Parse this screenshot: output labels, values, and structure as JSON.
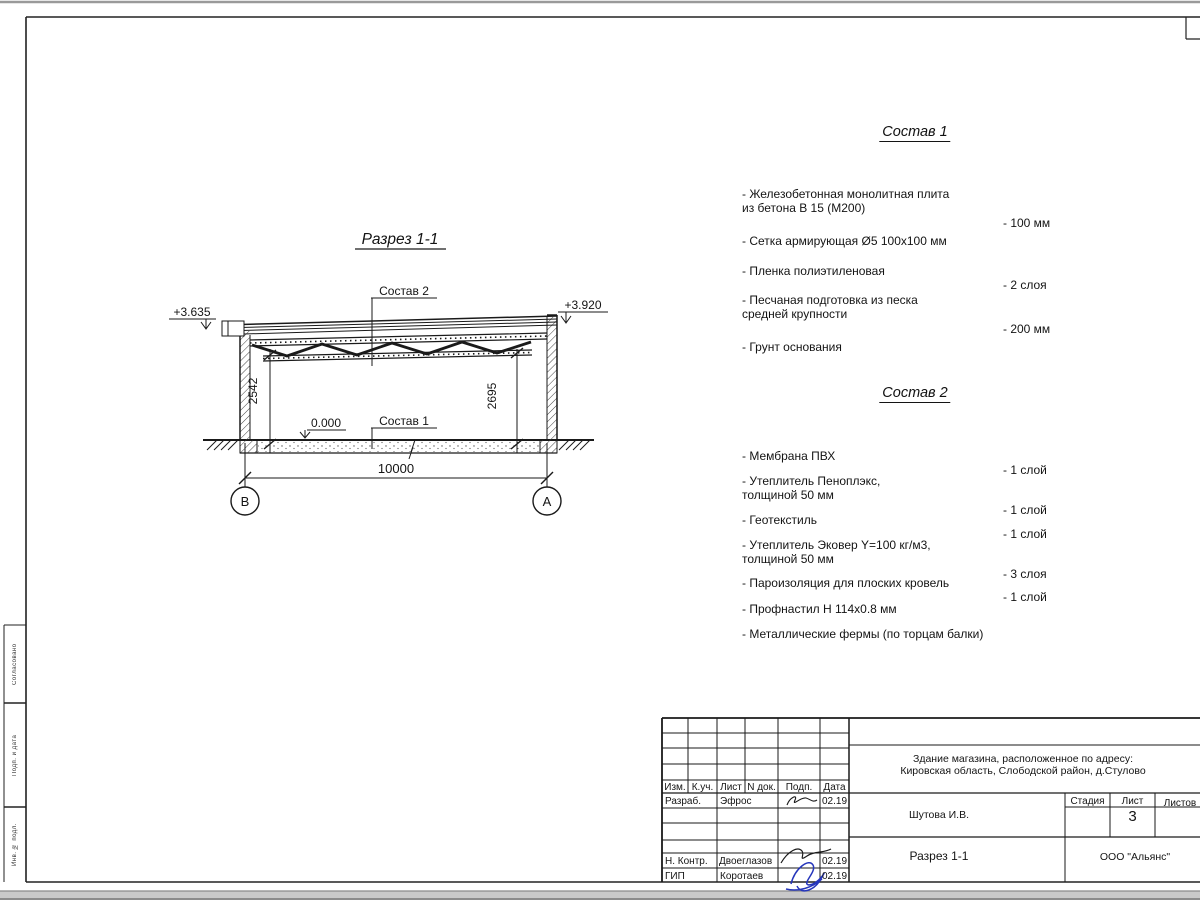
{
  "drawing": {
    "title": "Разрез 1-1",
    "elev_left": "+3.635",
    "elev_right": "+3.920",
    "label_sostav2": "Состав 2",
    "label_sostav1": "Состав 1",
    "level_zero": "0.000",
    "dim_left": "2542",
    "dim_right": "2695",
    "dim_span": "10000",
    "axis_left": "В",
    "axis_right": "А"
  },
  "sostav1": {
    "title": "Состав 1",
    "items": [
      {
        "name": "- Железобетонная  монолитная плита\nиз бетона В 15 (М200)",
        "value": "- 100 мм"
      },
      {
        "name": "- Сетка армирующая Ø5 100х100 мм",
        "value": ""
      },
      {
        "name": "- Пленка полиэтиленовая",
        "value": "-  2 слоя"
      },
      {
        "name": "- Песчаная подготовка из песка\nсредней крупности",
        "value": "- 200 мм"
      },
      {
        "name": "- Грунт основания",
        "value": ""
      }
    ]
  },
  "sostav2": {
    "title": "Состав 2",
    "items": [
      {
        "name": "- Мембрана ПВХ",
        "value": "- 1 слой"
      },
      {
        "name": "- Утеплитель Пеноплэкс,\nтолщиной 50 мм",
        "value": "- 1 слой"
      },
      {
        "name": "- Геотекстиль",
        "value": "- 1 слой"
      },
      {
        "name": "- Утеплитель Эковер Y=100 кг/м3,\nтолщиной 50 мм",
        "value": "- 3 слоя"
      },
      {
        "name": "- Пароизоляция для плоских кровель",
        "value": "- 1 слой"
      },
      {
        "name": "- Профнастил Н 114х0.8 мм",
        "value": ""
      },
      {
        "name": "- Металлические фермы (по торцам балки)",
        "value": ""
      }
    ]
  },
  "titleblock": {
    "header": {
      "izm": "Изм.",
      "kuch": "К.уч.",
      "list": "Лист",
      "ndok": "N док.",
      "podp": "Подп.",
      "data": "Дата"
    },
    "rows": [
      {
        "role": "Разраб.",
        "name": "Эфрос",
        "date": "02.19"
      },
      {
        "role": "Н. Контр.",
        "name": "Двоеглазов",
        "date": "02.19"
      },
      {
        "role": "ГИП",
        "name": "Коротаев",
        "date": "02.19"
      }
    ],
    "address_line1": "Здание магазина, расположенное по адресу:",
    "address_line2": "Кировская область, Слободской район, д.Стулово",
    "author": "Шутова И.В.",
    "stage_label": "Стадия",
    "sheet_label": "Лист",
    "sheets_label": "Листов",
    "sheet_number": "3",
    "doc_title": "Разрез 1-1",
    "company": "ООО \"Альянс\""
  },
  "sidebar": {
    "top": "Согласовано",
    "middle": "Подп. и дата",
    "bottom": "Инв. № подл."
  },
  "colors": {
    "line": "#1a1a1a",
    "signature_blue": "#2636bb",
    "scan_gray": "#c9c9c9"
  }
}
